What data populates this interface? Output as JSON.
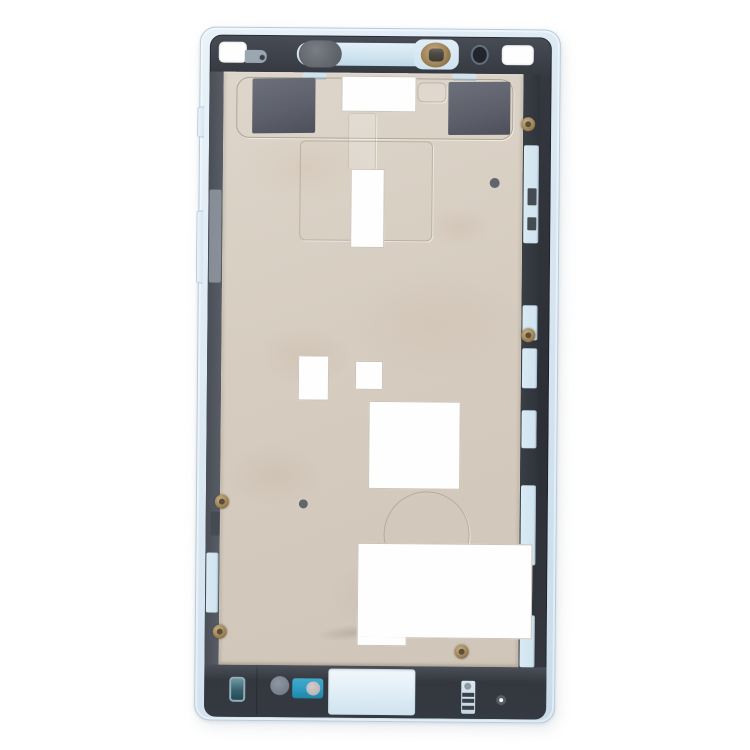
{
  "scene": {
    "type": "product-photo",
    "subject": "smartphone-middle-frame-housing-plate",
    "variant": "blue",
    "orientation": "front-facing, upright, slight clockwise tilt",
    "background": "#ffffff"
  },
  "colors": {
    "bg": "#ffffff",
    "frame-light": "#e9f2f9",
    "frame-mid": "#d6e5f1",
    "frame-deep": "#c9dcea",
    "frame-edge": "#b7cbda",
    "bezel-light": "#474c55",
    "bezel-dark": "#34373e",
    "bezel-deep": "#2c2f35",
    "plate-light": "#ded6cb",
    "plate": "#d6ccc0",
    "plate-deep": "#cfc5b9",
    "patch": "#5c5f6a",
    "patch-light": "#6d707b",
    "accent-blue": "#cfe3ef",
    "cutout-white": "#fefefe",
    "cutout-rim": "#cbc4ba",
    "bronze": "#a08457",
    "bronze-light": "#c7b18a",
    "bronze-dark": "#6f5b3e",
    "mesh-gray": "#63666d",
    "sensor-dark": "#22252a",
    "sensor-ring": "#63707d",
    "teal": "#36616c",
    "teal-light": "#6e98a2",
    "mic-gray": "#79828e",
    "port-blue": "#2f9dc3",
    "port-circle": "#c0b9ba",
    "dot-gray": "#60656e",
    "hole-ring": "#565c66"
  },
  "parts": {
    "outer_frame": "light blue plastic outer frame with rounded corners and two left-side tabs",
    "inner_bezel": "dark charcoal adhesive bezel border",
    "mid_plate": "beige metal shielding plate with stamped embossing",
    "top_corner_cutouts": 2,
    "earpiece_bar": "light blue recessed bar with dark speaker mesh oval",
    "front_camera": "bronze-ringed camera aperture in blue housing",
    "proximity_sensor": "dark circular sensor window with thin ring",
    "antenna_patches": 2,
    "white_cutouts": 7,
    "screws_bronze": 5,
    "alignment_dots": 2,
    "bottom_ports": [
      "teal jack cutout",
      "gray microphone hole",
      "blue port window with roller",
      "large light-blue loudspeaker opening",
      "spring contact connector",
      "ringed screw hole"
    ]
  }
}
